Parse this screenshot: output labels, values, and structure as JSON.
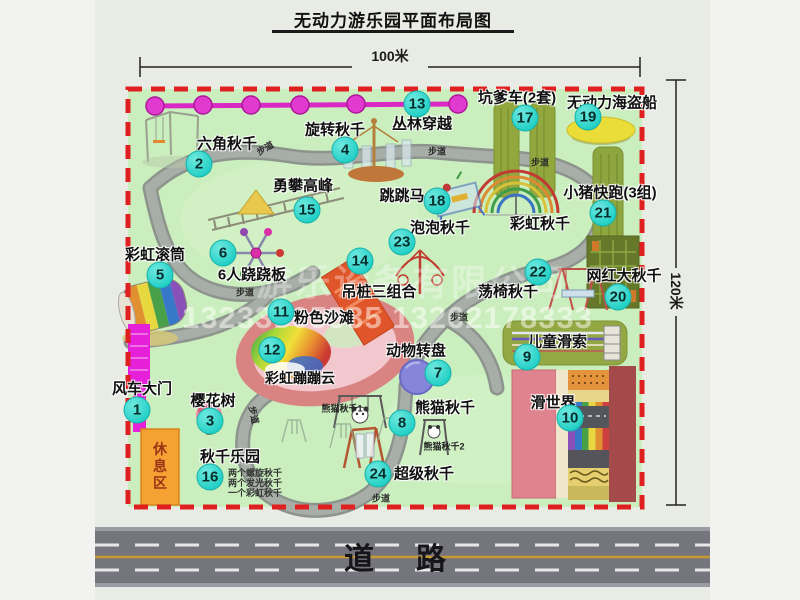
{
  "title": "无动力游乐园平面布局图",
  "dimensions": {
    "top": "100米",
    "right": "120米"
  },
  "road_label": "道路",
  "path_label": "步道",
  "rest_area_label": "休息区",
  "watermark": {
    "company": "游乐设备有限公司",
    "phone": "13233805535 13262178333"
  },
  "extra_labels": {
    "rainbow_swing_right": "彩虹秋千",
    "panda_swing_1": "熊猫秋千1",
    "panda_swing_2": "熊猫秋千2",
    "swing_park_items": [
      "两个螺旋秋千",
      "两个发光秋千",
      "一个彩虹秋千"
    ]
  },
  "attractions": [
    {
      "num": "1",
      "label": "风车大门"
    },
    {
      "num": "2",
      "label": "六角秋千"
    },
    {
      "num": "3",
      "label": "樱花树"
    },
    {
      "num": "4",
      "label": "旋转秋千"
    },
    {
      "num": "5",
      "label": "彩虹滚筒"
    },
    {
      "num": "6",
      "label": "6人跷跷板"
    },
    {
      "num": "7",
      "label": "动物转盘"
    },
    {
      "num": "8",
      "label": "熊猫秋千"
    },
    {
      "num": "9",
      "label": "儿童滑索"
    },
    {
      "num": "10",
      "label": "滑世界"
    },
    {
      "num": "11",
      "label": "粉色沙滩"
    },
    {
      "num": "12",
      "label": "彩虹蹦蹦云"
    },
    {
      "num": "13",
      "label": "丛林穿越"
    },
    {
      "num": "14",
      "label": "吊桩三组合"
    },
    {
      "num": "15",
      "label": "勇攀高峰"
    },
    {
      "num": "16",
      "label": "秋千乐园"
    },
    {
      "num": "17",
      "label": "坑爹车(2套)"
    },
    {
      "num": "18",
      "label": "跳跳马"
    },
    {
      "num": "19",
      "label": "无动力海盗船"
    },
    {
      "num": "20",
      "label": "网红大秋千"
    },
    {
      "num": "21",
      "label": "小猪快跑(3组)"
    },
    {
      "num": "22",
      "label": "荡椅秋千"
    },
    {
      "num": "23",
      "label": "泡泡秋千"
    },
    {
      "num": "24",
      "label": "超级秋千"
    }
  ],
  "colors": {
    "park_fill": "#cbeebf",
    "border_red": "#e02020",
    "badge_cyan": "#21cfc5",
    "gate_magenta": "#e520d8",
    "chain_magenta": "#e03ace",
    "road_gray": "#75757d"
  }
}
